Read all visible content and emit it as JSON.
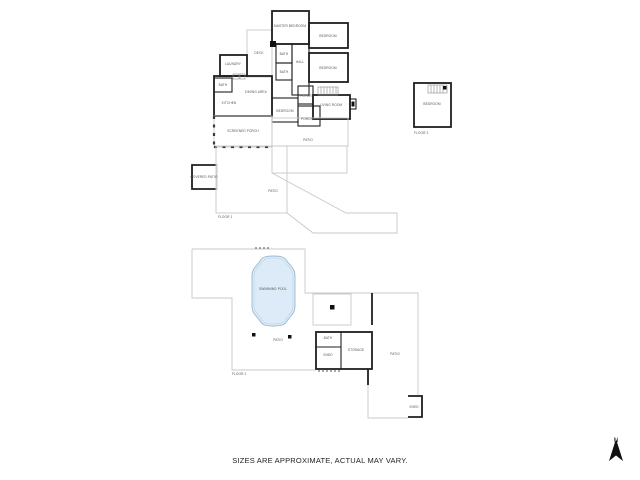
{
  "note": "SIZES ARE APPROXIMATE, ACTUAL MAY VARY.",
  "compass": {
    "label": "N"
  },
  "colors": {
    "wall": "#1f1f1f",
    "light": "#c8c8c8",
    "pool-fill": "#dcebf7",
    "pool-stroke": "#9db9d0",
    "pool-inner": "#bcd2e4",
    "label": "#555555",
    "note": "#222222"
  },
  "sections": [
    {
      "id": "main-house",
      "labels": [
        {
          "id": "master-bedroom",
          "text": "MASTER BEDROOM",
          "x": 290,
          "y": 27
        },
        {
          "id": "bedroom-ne",
          "text": "BEDROOM",
          "x": 328,
          "y": 37
        },
        {
          "id": "bedroom-e",
          "text": "BEDROOM",
          "x": 328,
          "y": 69
        },
        {
          "id": "bath-upper",
          "text": "BATH",
          "x": 284,
          "y": 55
        },
        {
          "id": "hall",
          "text": "HALL",
          "x": 300,
          "y": 63
        },
        {
          "id": "bath-middle",
          "text": "BATH",
          "x": 284,
          "y": 73
        },
        {
          "id": "laundry",
          "text": "LAUNDRY",
          "x": 233,
          "y": 65
        },
        {
          "id": "deck",
          "text": "DECK",
          "x": 259,
          "y": 54
        },
        {
          "id": "bath-lower",
          "text": "BATH",
          "x": 223,
          "y": 86
        },
        {
          "id": "dining-area",
          "text": "DINING AREA",
          "x": 256,
          "y": 93
        },
        {
          "id": "kitchen",
          "text": "KITCHEN",
          "x": 229,
          "y": 104
        },
        {
          "id": "bedroom-s",
          "text": "BEDROOM",
          "x": 285,
          "y": 112
        },
        {
          "id": "foyer",
          "text": "FOYER",
          "x": 306,
          "y": 97
        },
        {
          "id": "living-room",
          "text": "LIVING ROOM",
          "x": 331,
          "y": 106
        },
        {
          "id": "porch",
          "text": "PORCH",
          "x": 307,
          "y": 120
        },
        {
          "id": "screened-porch",
          "text": "SCREENED PORCH",
          "x": 243,
          "y": 132
        },
        {
          "id": "patio-rear",
          "text": "PATIO",
          "x": 308,
          "y": 141
        }
      ]
    },
    {
      "id": "detached-suite",
      "labels": [
        {
          "id": "bedroom-detached",
          "text": "BEDROOM",
          "x": 432,
          "y": 105
        },
        {
          "id": "floor-2",
          "text": "FLOOR 2",
          "x": 414,
          "y": 134,
          "anchor": "start"
        }
      ]
    },
    {
      "id": "patio-level",
      "labels": [
        {
          "id": "covered-patio",
          "text": "COVERED PATIO",
          "x": 204,
          "y": 178
        },
        {
          "id": "patio-mid",
          "text": "PATIO",
          "x": 273,
          "y": 192
        },
        {
          "id": "floor-1-mid",
          "text": "FLOOR 1",
          "x": 218,
          "y": 218,
          "anchor": "start"
        }
      ]
    },
    {
      "id": "pool-level",
      "labels": [
        {
          "id": "swimming-pool",
          "text": "SWIMMING POOL",
          "x": 273,
          "y": 290
        },
        {
          "id": "patio-pool",
          "text": "PATIO",
          "x": 278,
          "y": 341
        },
        {
          "id": "bath-pool",
          "text": "BATH",
          "x": 328,
          "y": 339
        },
        {
          "id": "shed-pool",
          "text": "SHED",
          "x": 328,
          "y": 356
        },
        {
          "id": "storage",
          "text": "STORAGE",
          "x": 356,
          "y": 351
        },
        {
          "id": "patio-right",
          "text": "PATIO",
          "x": 395,
          "y": 355
        },
        {
          "id": "floor-1-pool",
          "text": "FLOOR 1",
          "x": 232,
          "y": 375,
          "anchor": "start"
        },
        {
          "id": "shed-small",
          "text": "SHED",
          "x": 414,
          "y": 408
        }
      ]
    }
  ]
}
